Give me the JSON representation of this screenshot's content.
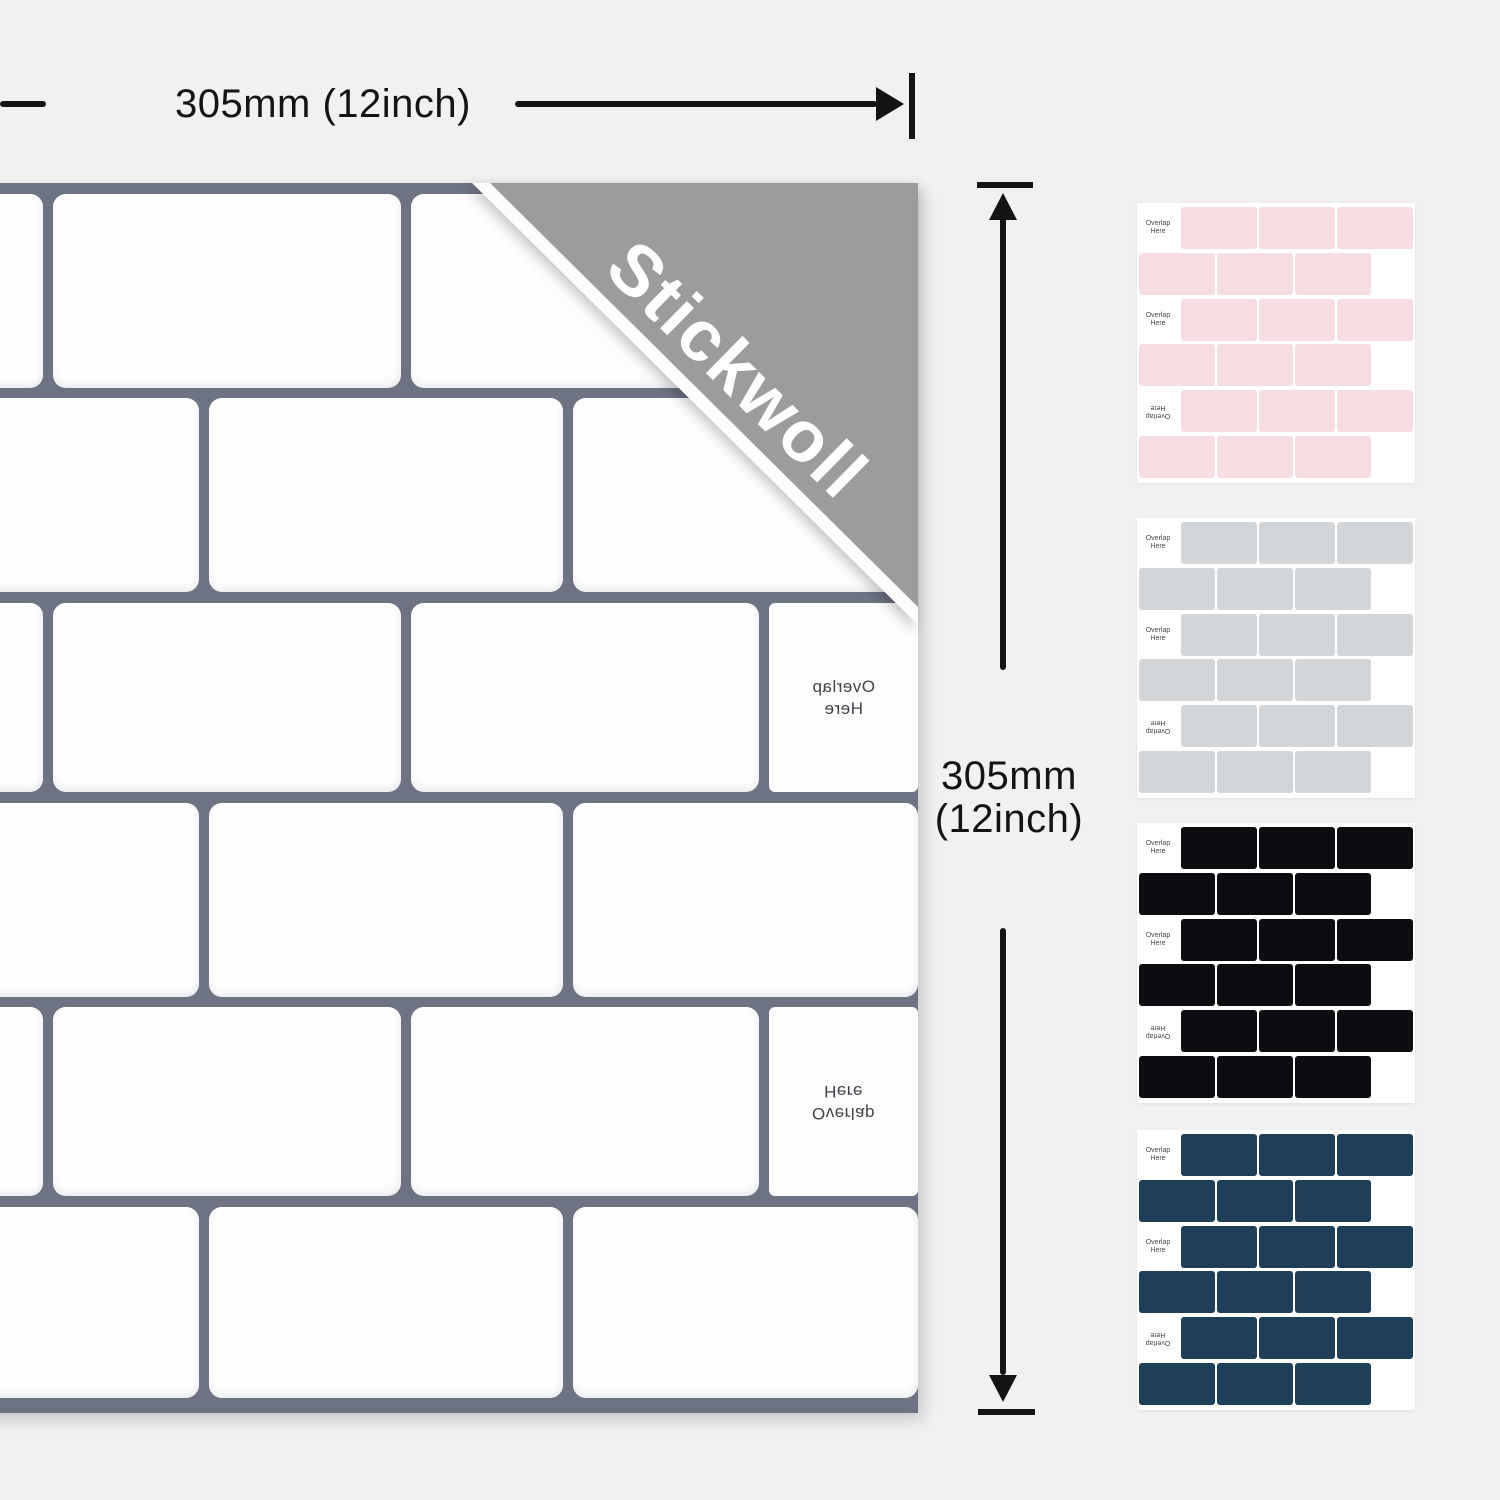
{
  "page": {
    "background": "#f1f1f1"
  },
  "brand": {
    "name": "Stickwoll",
    "ribbon_color": "#9c9c9c",
    "text_color": "#ffffff"
  },
  "main_sheet": {
    "grout_color": "#6d7383",
    "tile_color": "#fdfdfd",
    "overlap_label": {
      "line1": "Overlap",
      "line2": "Here"
    },
    "overlap_text_color": "#46404a"
  },
  "dimensions": {
    "arrow_color": "#141414",
    "width_label": "305mm (12inch)",
    "height_label_line1": "305mm",
    "height_label_line2": "(12inch)"
  },
  "swatches": {
    "sheet_background": "#ffffff",
    "label": {
      "line1": "Overlap",
      "line2": "Here"
    },
    "label_color": "#4a4a4a",
    "colors": [
      {
        "name": "pink",
        "hex": "#f5dde2"
      },
      {
        "name": "light-gray",
        "hex": "#d3d6d9"
      },
      {
        "name": "black",
        "hex": "#0d0d11"
      },
      {
        "name": "navy",
        "hex": "#1f3e58"
      }
    ]
  }
}
